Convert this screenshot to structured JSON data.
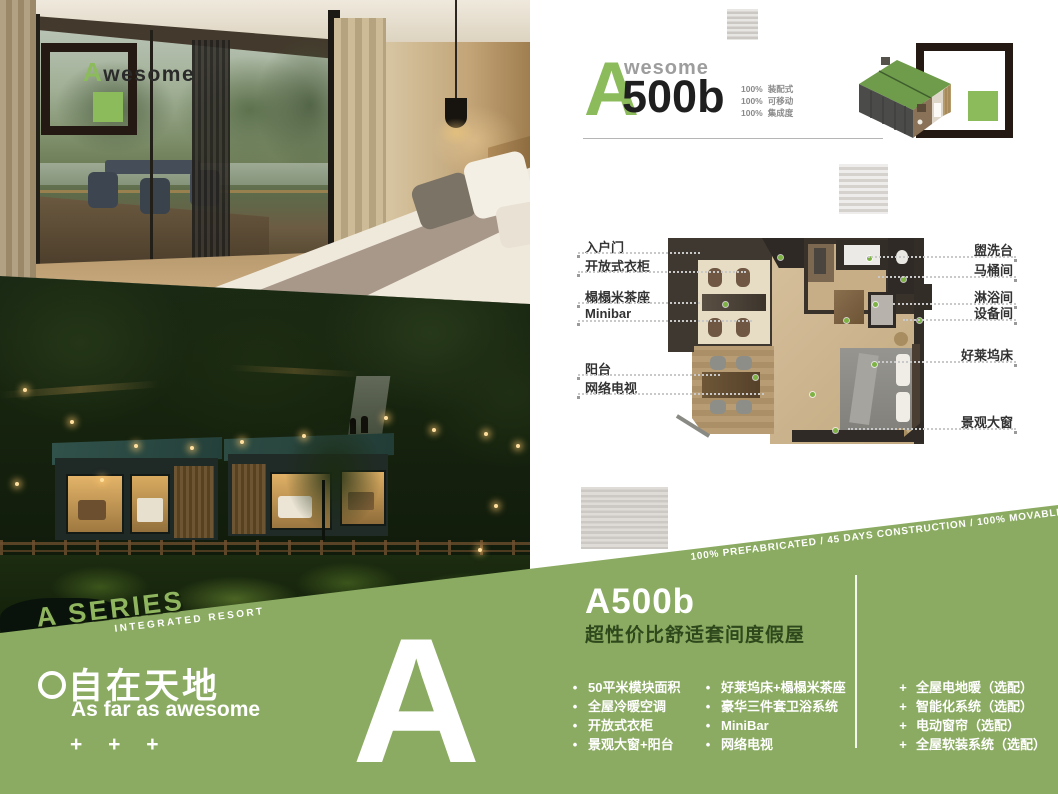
{
  "logo_overlay": {
    "first_letter": "A",
    "rest": "wesome"
  },
  "header": {
    "brand_first_letter": "A",
    "brand_rest": "wesome",
    "model": "500b",
    "specs": [
      {
        "pct": "100%",
        "label": "装配式"
      },
      {
        "pct": "100%",
        "label": "可移动"
      },
      {
        "pct": "100%",
        "label": "集成度"
      }
    ]
  },
  "floorplan": {
    "labels_left": [
      "入户门",
      "开放式衣柜",
      "榻榻米茶座",
      "Minibar",
      "阳台",
      "网络电视"
    ],
    "labels_right": [
      "盥洗台",
      "马桶间",
      "淋浴间",
      "设备间",
      "好莱坞床",
      "景观大窗"
    ]
  },
  "series": {
    "title": "A SERIES",
    "subtitle": "INTEGRATED RESORT"
  },
  "banner": {
    "diagonal_text": "100% PREFABRICATED / 45 DAYS CONSTRUCTION / 100% MOVABLE",
    "slogan_cn": "自在天地",
    "slogan_en": "As far as awesome",
    "plus_marks": "+ + +",
    "big_letter": "A",
    "model_title": "A500b",
    "model_subtitle": "超性价比舒适套间度假屋",
    "bullet_marker": "•",
    "plus_marker": "+",
    "features_col1": [
      "50平米模块面积",
      "全屋冷暖空调",
      "开放式衣柜",
      "景观大窗+阳台"
    ],
    "features_col2": [
      "好莱坞床+榻榻米茶座",
      "豪华三件套卫浴系统",
      "MiniBar",
      "网络电视"
    ],
    "features_col3": [
      "全屋电地暖（选配）",
      "智能化系统（选配）",
      "电动窗帘（选配）",
      "全屋软装系统（选配）"
    ]
  },
  "colors": {
    "accent_green": "#8cbb5c",
    "banner_green": "#8bab62",
    "dark_frame": "#241a13",
    "subtitle_green": "#2e481c",
    "roof_green": "#6e9c4a"
  }
}
